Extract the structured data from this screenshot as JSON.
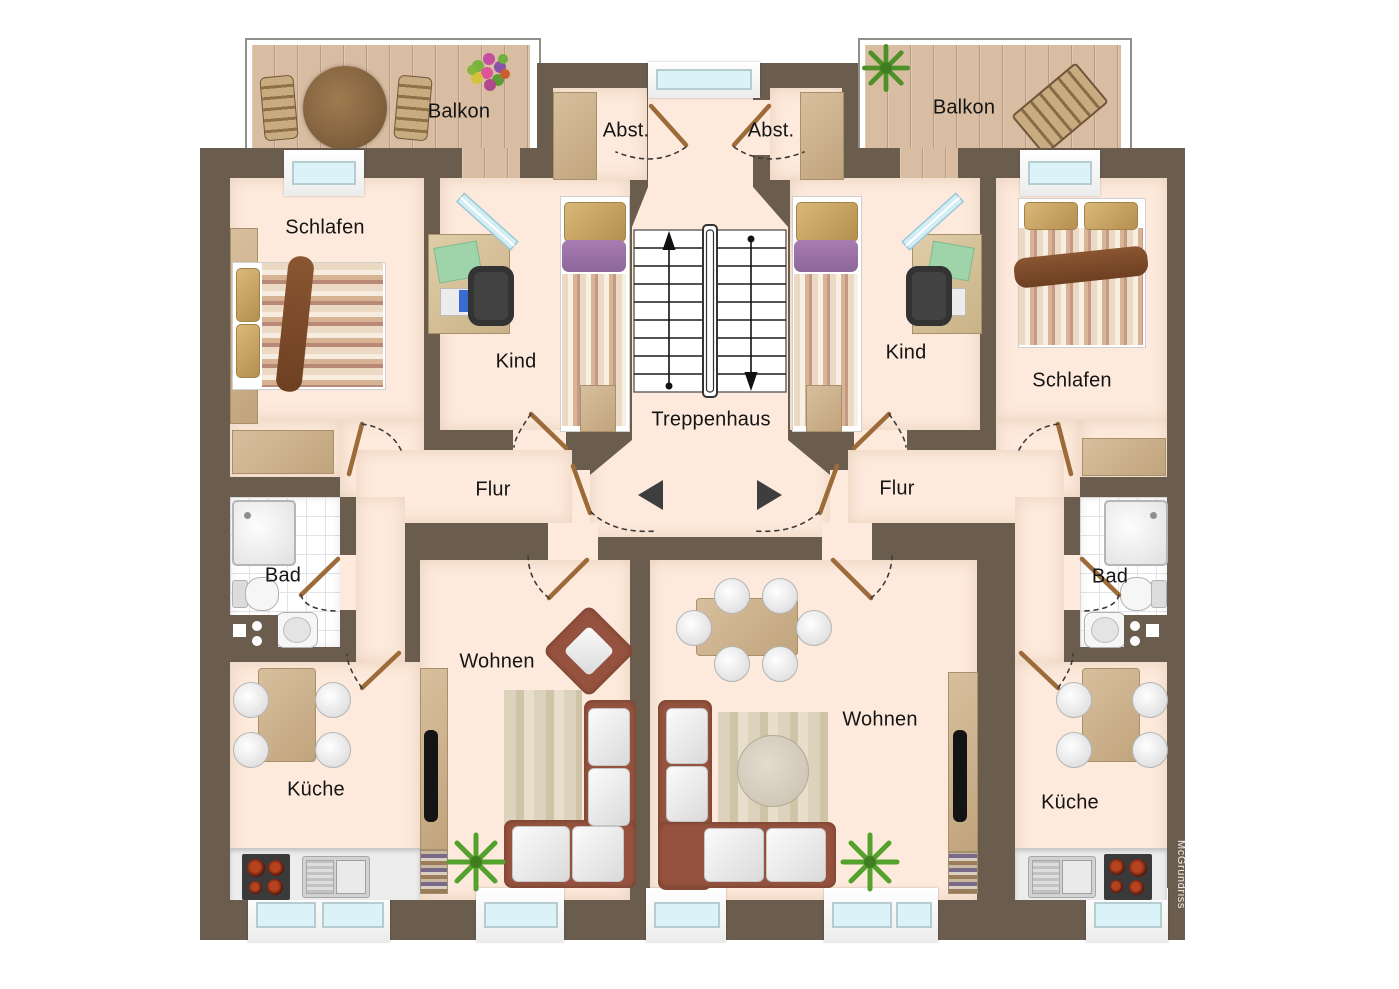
{
  "plan": {
    "watermark": "McGrundriss",
    "labels": {
      "balcony_left": "Balkon",
      "balcony_right": "Balkon",
      "storage_left": "Abst.",
      "storage_right": "Abst.",
      "stairwell": "Treppenhaus",
      "bedroom_left": "Schlafen",
      "bedroom_right": "Schlafen",
      "child_left": "Kind",
      "child_right": "Kind",
      "hall_left": "Flur",
      "hall_right": "Flur",
      "bath_left": "Bad",
      "bath_right": "Bad",
      "living_left": "Wohnen",
      "living_right": "Wohnen",
      "kitchen_left": "Küche",
      "kitchen_right": "Küche"
    },
    "icons": {
      "entry_arrow_left": "left-triangle",
      "entry_arrow_right": "right-triangle",
      "stairs_up_arrow": "up-arrow",
      "stairs_down_arrow": "down-arrow"
    },
    "colors": {
      "wall": "#6b5d4e",
      "floor": "#fdeadc",
      "balcony_wood": "#d9bda2",
      "window_glass": "#d9f3f8",
      "door": "#9c6b39",
      "accent_purple": "#9d72a6",
      "sofa": "#95523e",
      "plant": "#55a12e"
    }
  }
}
